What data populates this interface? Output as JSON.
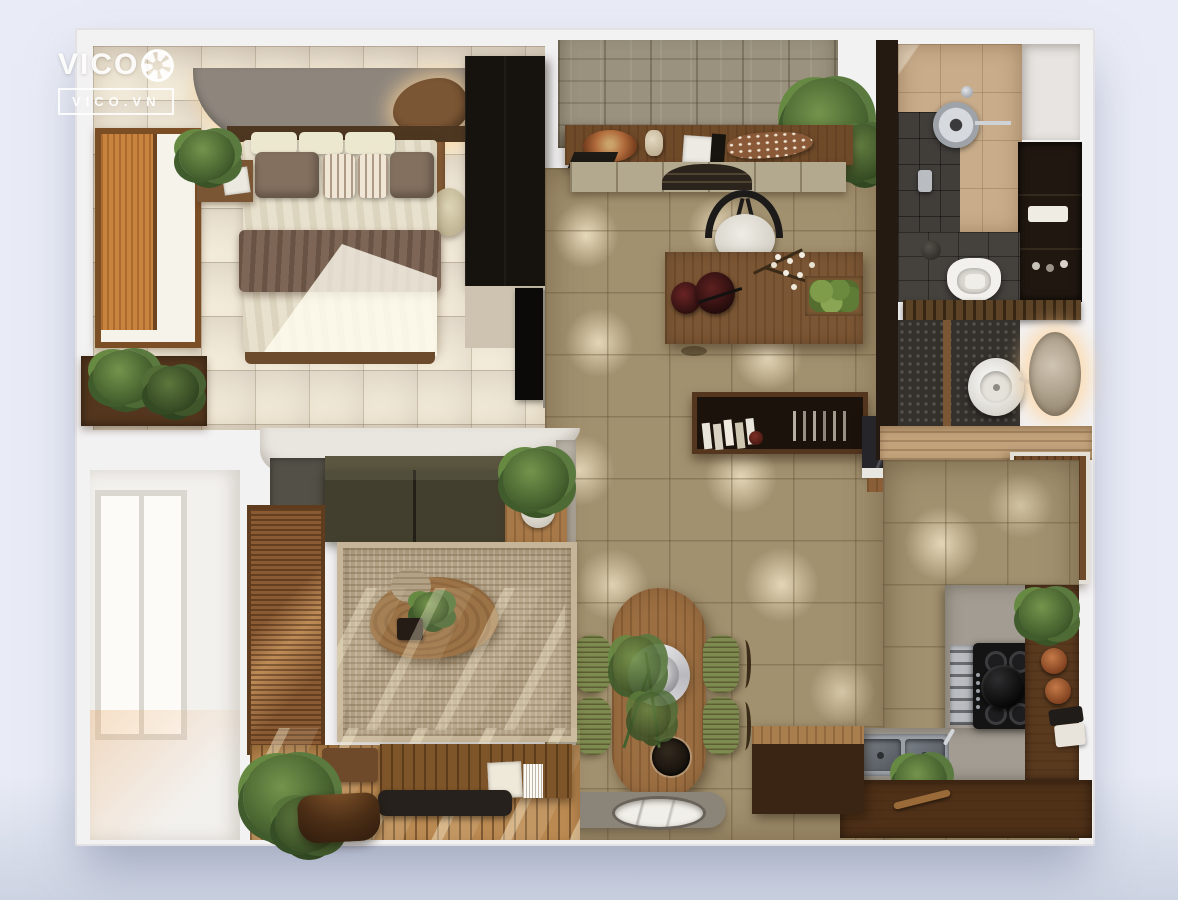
{
  "watermark": {
    "brand": "VICO",
    "domain": "VICO.VN"
  },
  "scene": {
    "type": "3d-apartment-floor-plan-render",
    "view": "top-down",
    "rooms": [
      {
        "name": "bedroom",
        "items": [
          "double-bed",
          "cream-pillows",
          "brown-pillows",
          "throw-blanket",
          "nightstand",
          "potted-plant",
          "window-orange-blind",
          "curved-ceiling-slab",
          "backlit-vanity-shelf",
          "dresser",
          "stool",
          "wardrobe",
          "tv-panel",
          "planter-ledge"
        ]
      },
      {
        "name": "entry-study",
        "items": [
          "textured-feature-wall",
          "console-shelf",
          "decor-plate",
          "vase",
          "books",
          "fish-sculpture",
          "wall-cabinets",
          "wishbone-chair",
          "writing-desk",
          "desk-lamp",
          "flower-branch",
          "moss-tray",
          "hanging-plant"
        ]
      },
      {
        "name": "bathroom",
        "items": [
          "rain-shower",
          "marble-wall-tiles",
          "slate-floor",
          "storage-cabinet",
          "toilet",
          "slatted-partition",
          "vessel-sink",
          "backlit-round-mirror"
        ]
      },
      {
        "name": "kitchen",
        "items": [
          "entrance-door",
          "dark-marble-counter",
          "bar-shelf-books",
          "concrete-counter",
          "gas-hob",
          "stock-pot",
          "oven",
          "double-sink",
          "herb-plant",
          "spice-jars",
          "serving-bowl",
          "open-wood-shelf",
          "island-cabinet"
        ]
      },
      {
        "name": "dining",
        "items": [
          "oval-wood-table",
          "round-pendant-lamp",
          "green-dining-chairs",
          "table-plant",
          "stone-platform",
          "marble-basin"
        ]
      },
      {
        "name": "living",
        "items": [
          "olive-sofa",
          "side-table-plant",
          "jute-rug",
          "kidney-coffee-table",
          "bamboo-blind-door",
          "balcony-doors",
          "wood-deck",
          "slatted-bench",
          "books",
          "black-tray",
          "floor-plants",
          "curved-stool",
          "sunlight-streaks"
        ]
      }
    ]
  },
  "palette": {
    "bg": "#e9ecf6",
    "bg_shadow": "#ccd3e2",
    "wall_white": "#f3f2f3",
    "wall_beige": "#cdc3b0",
    "floor_center": "#a2916f",
    "floor_bedroom": "#d8cec0",
    "wood_dark": "#53361d",
    "wood": "#8a5f38",
    "wood_light": "#bb8a52",
    "walnut": "#7b5634",
    "dark_furniture": "#16120e",
    "sofa": "#433f2e",
    "rug": "#b3a185",
    "chair_green": "#7e8b50",
    "marble_beige": "#c9ad8b",
    "slate": "#413e3a",
    "concrete": "#a29c92",
    "steel": "#b9bcc0",
    "copper": "#b06a3a",
    "plant": "#4e6b35",
    "led_glow": "#ffdfae",
    "stone": "#8b8478"
  }
}
